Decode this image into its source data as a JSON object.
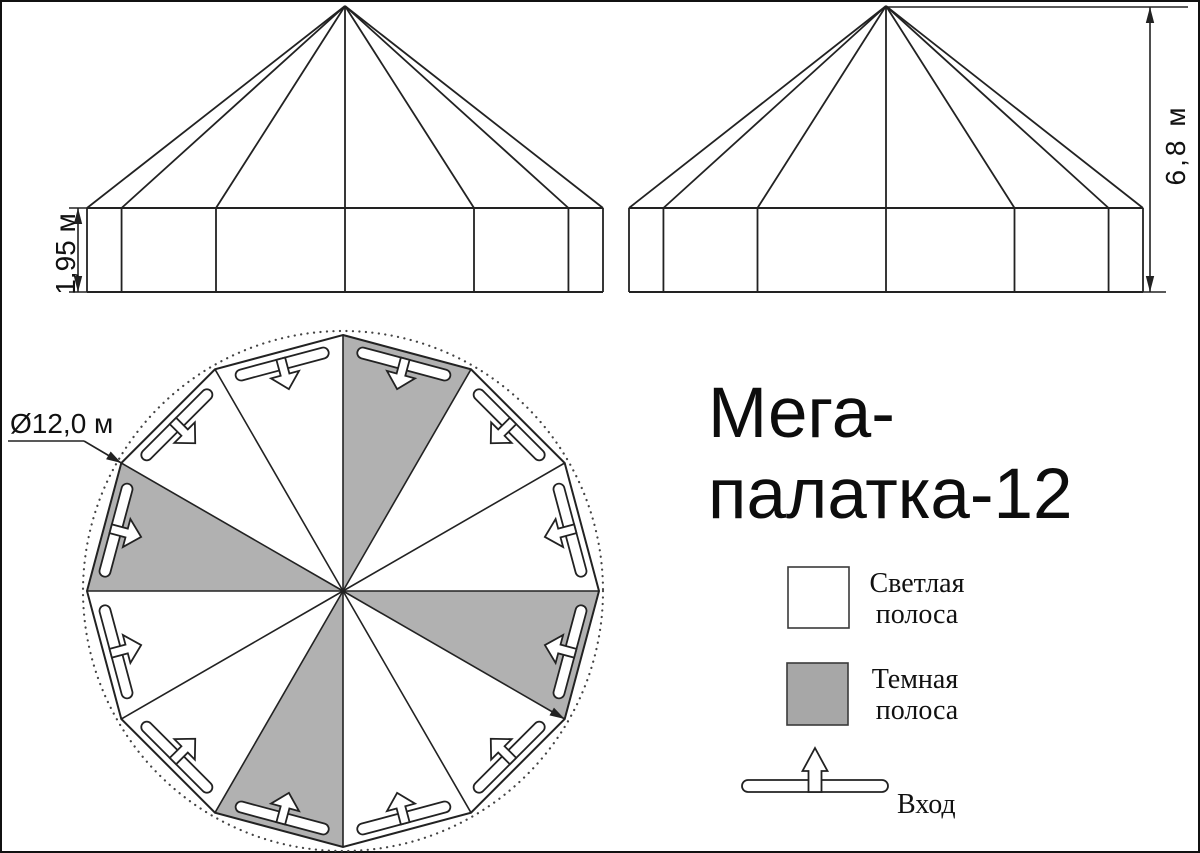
{
  "title": {
    "line1": "Мега-",
    "line2": "палатка-12"
  },
  "views": {
    "front_elevation": {
      "label": "front elevation",
      "height_dim_label": "1,95 м"
    },
    "side_elevation": {
      "label": "side elevation",
      "height_dim_label": "6,8 м"
    },
    "plan": {
      "diameter_label": "Ø12,0 м"
    }
  },
  "legend": {
    "light": {
      "line1": "Светлая",
      "line2": "полоса"
    },
    "dark": {
      "line1": "Темная",
      "line2": "полоса"
    },
    "entrance_label": "Вход"
  },
  "colors": {
    "background": "#ffffff",
    "line": "#222222",
    "frame": "#111111",
    "dark_stripe_plan": "#b1b1b1",
    "dark_stripe_legend": "#a7a7a7",
    "dotted": "#444444",
    "text": "#111111"
  },
  "geometry": {
    "canvas": {
      "width": 1200,
      "height": 853
    },
    "elevation": {
      "apex_y": 6,
      "wall_top_y": 208,
      "wall_bottom_y": 292,
      "front": {
        "cx": 345,
        "radius": 258
      },
      "side": {
        "cx": 886,
        "radius": 257
      }
    },
    "wall_dim": {
      "line_x": 78,
      "tick_x1": 69,
      "tick_x2": 88
    },
    "height_dim": {
      "line_x": 1150,
      "top_y": 7,
      "top_tick_x2": 1188,
      "bottom_tick_x1": 1141,
      "bottom_tick_x2": 1166
    },
    "plan": {
      "cx": 343,
      "cy": 591,
      "radius": 256,
      "dotted_radius": 260,
      "sectors": 12,
      "dark_sectors": [
        0,
        3,
        6,
        9
      ],
      "entrance": {
        "bar_radius": 235,
        "bar_half_length": 48,
        "bar_half_width": 5.5,
        "shaft_half_width": 4.5,
        "head_half_width": 14.5,
        "head_base_radius": 224,
        "tip_radius": 209
      },
      "leader": {
        "x1": 8,
        "y1": 441,
        "x2": 84,
        "y2": 441,
        "vertex_angle": 150,
        "far_vertex_angle": -30
      }
    },
    "legend": {
      "light_box": {
        "x": 788,
        "y": 567,
        "w": 61,
        "h": 61
      },
      "dark_box": {
        "x": 787,
        "y": 663,
        "w": 61,
        "h": 62
      },
      "bar": {
        "x": 742,
        "y": 780,
        "w": 146,
        "h": 12
      },
      "arrow": {
        "cx": 815,
        "tip_y": 748,
        "head_base_y": 771,
        "head_half_width": 12.5,
        "shaft_half_width": 6.5,
        "tail_y": 792
      }
    }
  }
}
